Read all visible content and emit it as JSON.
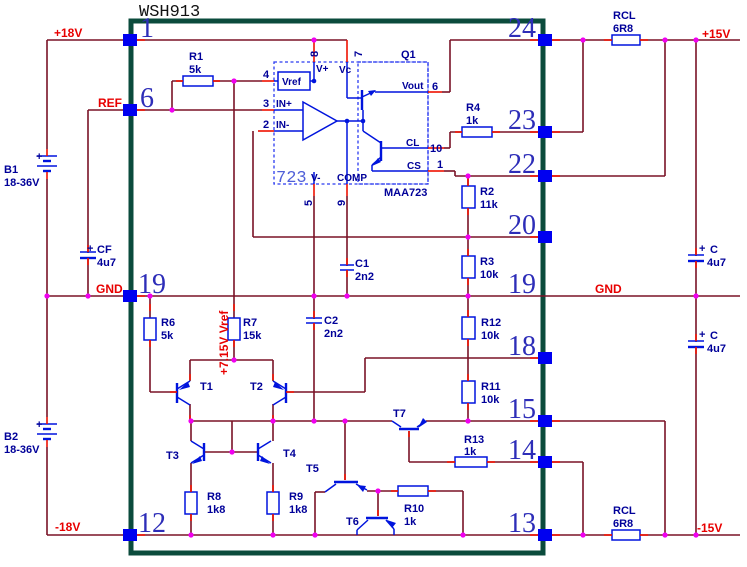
{
  "chip": {
    "title": "WSH913",
    "left_pins": {
      "p1": "1",
      "p6": "6",
      "p19": "19",
      "p12": "12"
    },
    "right_pins": {
      "p24": "24",
      "p23": "23",
      "p22": "22",
      "p20": "20",
      "p19": "19",
      "p18": "18",
      "p15": "15",
      "p14": "14",
      "p13": "13"
    }
  },
  "nets": {
    "plus18": "+18V",
    "ref": "REF",
    "gnd_left": "GND",
    "minus18": "-18V",
    "plus15": "+15V",
    "gnd_right": "GND",
    "minus15": "-15V",
    "vref_rail": "+7.15V Vref"
  },
  "batteries": {
    "b1": {
      "name": "B1",
      "value": "18-36V",
      "polarity": "+"
    },
    "b2": {
      "name": "B2",
      "value": "18-36V",
      "polarity": "+"
    }
  },
  "capacitors": {
    "cf": {
      "name": "CF",
      "value": "4u7",
      "polarity": "+"
    },
    "c1": {
      "name": "C1",
      "value": "2n2"
    },
    "c2": {
      "name": "C2",
      "value": "2n2"
    },
    "c_top": {
      "name": "C",
      "value": "4u7",
      "polarity": "+"
    },
    "c_bottom": {
      "name": "C",
      "value": "4u7",
      "polarity": "+"
    }
  },
  "resistors": {
    "r1": {
      "name": "R1",
      "value": "5k"
    },
    "r2": {
      "name": "R2",
      "value": "11k"
    },
    "r3": {
      "name": "R3",
      "value": "10k"
    },
    "r4": {
      "name": "R4",
      "value": "1k"
    },
    "r6": {
      "name": "R6",
      "value": "5k"
    },
    "r7": {
      "name": "R7",
      "value": "15k"
    },
    "r8": {
      "name": "R8",
      "value": "1k8"
    },
    "r9": {
      "name": "R9",
      "value": "1k8"
    },
    "r10": {
      "name": "R10",
      "value": "1k"
    },
    "r11": {
      "name": "R11",
      "value": "10k"
    },
    "r12": {
      "name": "R12",
      "value": "10k"
    },
    "r13": {
      "name": "R13",
      "value": "1k"
    },
    "rcl_top": {
      "name": "RCL",
      "value": "6R8"
    },
    "rcl_bottom": {
      "name": "RCL",
      "value": "6R8"
    }
  },
  "transistors": {
    "t1": "T1",
    "t2": "T2",
    "t3": "T3",
    "t4": "T4",
    "t5": "T5",
    "t6": "T6",
    "t7": "T7"
  },
  "regulator": {
    "big_label": "723",
    "part": "MAA723",
    "q1": "Q1",
    "pads": {
      "vref": "Vref",
      "vplus": "V+",
      "vc": "Vc",
      "vout": "Vout",
      "in_plus": "IN+",
      "in_minus": "IN-",
      "v_minus": "V-",
      "comp": "COMP",
      "cl": "CL",
      "cs": "CS"
    },
    "pad_numbers": {
      "n8": "8",
      "n7": "7",
      "n6": "6",
      "n4": "4",
      "n3": "3",
      "n2": "2",
      "n10": "10",
      "n1": "1",
      "n5": "5",
      "n9": "9"
    }
  },
  "colors": {
    "wire": "#7a1226",
    "pin_red": "#ee1100",
    "component_blue": "#0014dd",
    "dashed_blue": "#2b3bf0",
    "label_navy": "#000099",
    "pin_text_blue": "#2d2db8",
    "junction_magenta": "#f000f0",
    "border_green": "#0b4b3c",
    "net_label_red": "#e80000"
  }
}
